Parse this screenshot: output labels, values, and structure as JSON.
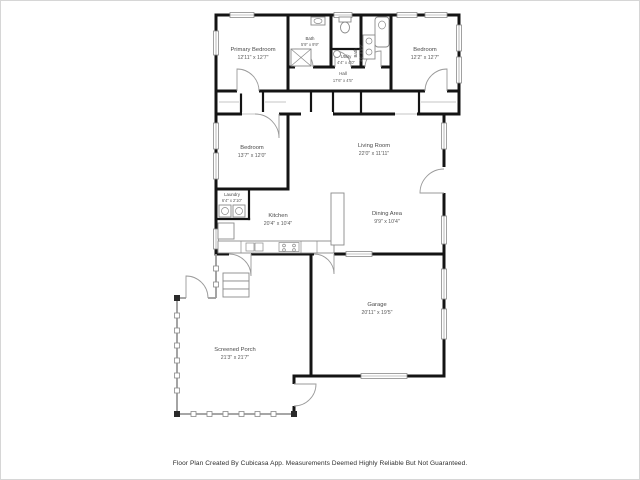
{
  "footer": {
    "disclaimer": "Floor Plan Created By Cubicasa App. Measurements Deemed Highly Reliable But Not Guaranteed."
  },
  "floor_plan": {
    "wall_color": "#141414",
    "background": "#ffffff",
    "rooms": [
      {
        "id": "primary-bedroom",
        "name": "Primary Bedroom",
        "dimensions": "12'11\" x 12'7\""
      },
      {
        "id": "bath-1",
        "name": "Bath",
        "dimensions": "5'9\" x 9'9\""
      },
      {
        "id": "bath-2",
        "name": "Bath",
        "dimensions": "4'6\" x 9'9\""
      },
      {
        "id": "utility",
        "name": "Utility",
        "dimensions": "4'4\" x 4'0\""
      },
      {
        "id": "hall",
        "name": "Hall",
        "dimensions": "17'6\" x 4'5\""
      },
      {
        "id": "bedroom-2",
        "name": "Bedroom",
        "dimensions": "12'2\" x 12'7\""
      },
      {
        "id": "bedroom-3",
        "name": "Bedroom",
        "dimensions": "13'7\" x 12'0\""
      },
      {
        "id": "living-room",
        "name": "Living Room",
        "dimensions": "22'0\" x 11'11\""
      },
      {
        "id": "laundry",
        "name": "Laundry",
        "dimensions": "6'4\" x 2'10\""
      },
      {
        "id": "kitchen",
        "name": "Kitchen",
        "dimensions": "20'4\" x 10'4\""
      },
      {
        "id": "dining-area",
        "name": "Dining Area",
        "dimensions": "9'9\" x 10'4\""
      },
      {
        "id": "garage",
        "name": "Garage",
        "dimensions": "20'11\" x 19'5\""
      },
      {
        "id": "screened-porch",
        "name": "Screened Porch",
        "dimensions": "21'3\" x 21'7\""
      }
    ]
  }
}
